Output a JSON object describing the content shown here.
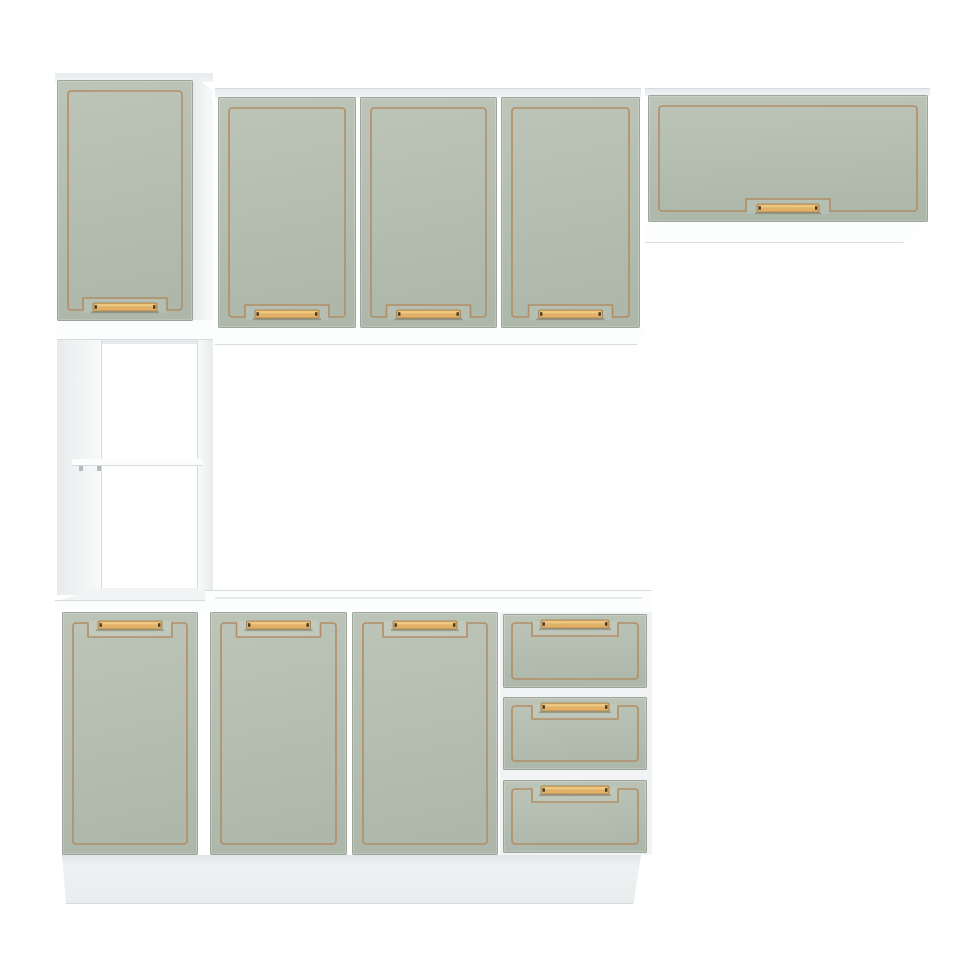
{
  "meta": {
    "description": "Product photo of a modular kitchen cabinet set: sage green doors and drawer fronts with thin gold trim outlines and recessed gold bar handles, white carcass, tall left column with open shelf niche, three upper wall doors, a horizontal flip-up wall cabinet, three base doors, a three-drawer stack and a white plinth on a plain white background."
  },
  "colors": {
    "background": "#ffffff",
    "door_face_top": "#bcc5b8",
    "door_face_bottom": "#adb7aa",
    "door_outline": "#8f998c",
    "trim": "#b28e66",
    "handle_bar": "#e2b168",
    "handle_bar_highlight": "#f3cf8b",
    "handle_bar_stroke": "#9c7847",
    "handle_end": "#493c2a",
    "recess_shadow": "rgba(80,68,45,0.35)",
    "edge_line": "#d7dbdd",
    "panel_white": "#fcfdfd",
    "panel_sliver": "#f0f3f4",
    "panel_side_dark": "#e8ebed",
    "panel_side_light": "#f8fafa",
    "panel_floor": "#f1f3f4",
    "panel_shade": "#e7eaec",
    "plinth_top": "#e0e4e6",
    "plinth_mid": "#eef1f2",
    "plinth_bottom": "#e9edee",
    "support_dot": "#b4babc"
  },
  "scene": {
    "width": 975,
    "height": 975,
    "parts": [
      {
        "name": "tall-cabinet-top-edge",
        "kind": "panel",
        "x": 55,
        "y": 73,
        "w": 158,
        "h": 9,
        "fill": "sliver"
      },
      {
        "name": "tall-cabinet-side-panel",
        "kind": "panel",
        "x": 193,
        "y": 75,
        "w": 20,
        "h": 265,
        "fill": "side",
        "clip": "polygon(0 0,100% 6%,100% 100%,0 100%)"
      },
      {
        "name": "tall-upper-bottom-panel",
        "kind": "panel",
        "x": 57,
        "y": 320,
        "w": 156,
        "h": 20,
        "fill": "white",
        "lines": [
          "bottom"
        ]
      },
      {
        "name": "upper-row-top-edge",
        "kind": "panel",
        "x": 215,
        "y": 88,
        "w": 426,
        "h": 10,
        "fill": "sliver",
        "lines": [
          "top"
        ]
      },
      {
        "name": "upper-row-bottom-panel",
        "kind": "panel",
        "x": 215,
        "y": 328,
        "w": 430,
        "h": 17,
        "fill": "white",
        "lines": [
          "bottom"
        ],
        "clip": "polygon(0 0,100% 0,100% 55%,98% 100%,0 100%)"
      },
      {
        "name": "wall-cabinet-top-edge",
        "kind": "panel",
        "x": 645,
        "y": 88,
        "w": 285,
        "h": 8,
        "fill": "sliver",
        "lines": [
          "top"
        ]
      },
      {
        "name": "wall-cabinet-bottom-panel",
        "kind": "panel",
        "x": 645,
        "y": 222,
        "w": 285,
        "h": 21,
        "fill": "white",
        "lines": [
          "bottom"
        ],
        "clip": "polygon(0 0,100% 0,90.5% 100%,0 100%)"
      },
      {
        "name": "niche-left-wall",
        "kind": "panel",
        "x": 57,
        "y": 340,
        "w": 45,
        "h": 255,
        "fill": "side",
        "lines": [
          "right"
        ]
      },
      {
        "name": "niche-right-wall",
        "kind": "panel",
        "x": 197,
        "y": 340,
        "w": 16,
        "h": 255,
        "fill": "sideR",
        "lines": [
          "left"
        ]
      },
      {
        "name": "niche-top-shadow",
        "kind": "panel",
        "x": 102,
        "y": 340,
        "w": 95,
        "h": 4,
        "fill": "shade"
      },
      {
        "name": "open-shelf",
        "kind": "panel",
        "x": 72,
        "y": 459,
        "w": 130,
        "h": 7,
        "fill": "white",
        "lines": [
          "bottom"
        ]
      },
      {
        "name": "shelf-support-left",
        "kind": "panel",
        "x": 79,
        "y": 466,
        "w": 4,
        "h": 5,
        "fill": "dot"
      },
      {
        "name": "shelf-support-right",
        "kind": "panel",
        "x": 97,
        "y": 466,
        "w": 4,
        "h": 5,
        "fill": "dot"
      },
      {
        "name": "niche-floor",
        "kind": "panel",
        "x": 57,
        "y": 588,
        "w": 156,
        "h": 13,
        "fill": "floor",
        "clip": "polygon(28% 0,90% 0,100% 100%,0 100%)"
      },
      {
        "name": "tall-base-top-panel",
        "kind": "panel",
        "x": 55,
        "y": 600,
        "w": 158,
        "h": 12,
        "fill": "white",
        "lines": [
          "top"
        ]
      },
      {
        "name": "base-top-panel",
        "kind": "panel",
        "x": 205,
        "y": 590,
        "w": 447,
        "h": 22,
        "fill": "white",
        "lines": [
          "top"
        ]
      },
      {
        "name": "base-top-inner-edge",
        "kind": "panel",
        "x": 215,
        "y": 597,
        "w": 427,
        "h": 2,
        "fill": "shade"
      },
      {
        "name": "drawer-stack-backing",
        "kind": "panel",
        "x": 500,
        "y": 612,
        "w": 152,
        "h": 243,
        "fill": "floor"
      },
      {
        "name": "plinth",
        "kind": "panel",
        "x": 62,
        "y": 855,
        "w": 579,
        "h": 49,
        "fill": "plinth",
        "clip": "polygon(0 0,100% 0,98.7% 100%,0.7% 100%)",
        "lines": [
          "bottom"
        ]
      },
      {
        "name": "tall-upper-door",
        "kind": "front",
        "x": 57,
        "y": 80,
        "w": 136,
        "h": 241,
        "handle": "bottom"
      },
      {
        "name": "upper-door-1",
        "kind": "front",
        "x": 218,
        "y": 97,
        "w": 138,
        "h": 231,
        "handle": "bottom"
      },
      {
        "name": "upper-door-2",
        "kind": "front",
        "x": 360,
        "y": 97,
        "w": 137,
        "h": 231,
        "handle": "bottom"
      },
      {
        "name": "upper-door-3",
        "kind": "front",
        "x": 501,
        "y": 97,
        "w": 139,
        "h": 231,
        "handle": "bottom"
      },
      {
        "name": "wall-flip-door",
        "kind": "front",
        "x": 648,
        "y": 95,
        "w": 280,
        "h": 127,
        "handle": "bottom"
      },
      {
        "name": "base-door-1",
        "kind": "front",
        "x": 62,
        "y": 612,
        "w": 136,
        "h": 243,
        "handle": "top"
      },
      {
        "name": "base-door-2",
        "kind": "front",
        "x": 210,
        "y": 612,
        "w": 137,
        "h": 243,
        "handle": "top"
      },
      {
        "name": "base-door-3",
        "kind": "front",
        "x": 352,
        "y": 612,
        "w": 146,
        "h": 243,
        "handle": "top"
      },
      {
        "name": "drawer-front-1",
        "kind": "front",
        "x": 503,
        "y": 614,
        "w": 144,
        "h": 74,
        "handle": "drawer"
      },
      {
        "name": "drawer-front-2",
        "kind": "front",
        "x": 503,
        "y": 697,
        "w": 144,
        "h": 73,
        "handle": "drawer"
      },
      {
        "name": "drawer-front-3",
        "kind": "front",
        "x": 503,
        "y": 780,
        "w": 144,
        "h": 73,
        "handle": "drawer"
      }
    ]
  }
}
